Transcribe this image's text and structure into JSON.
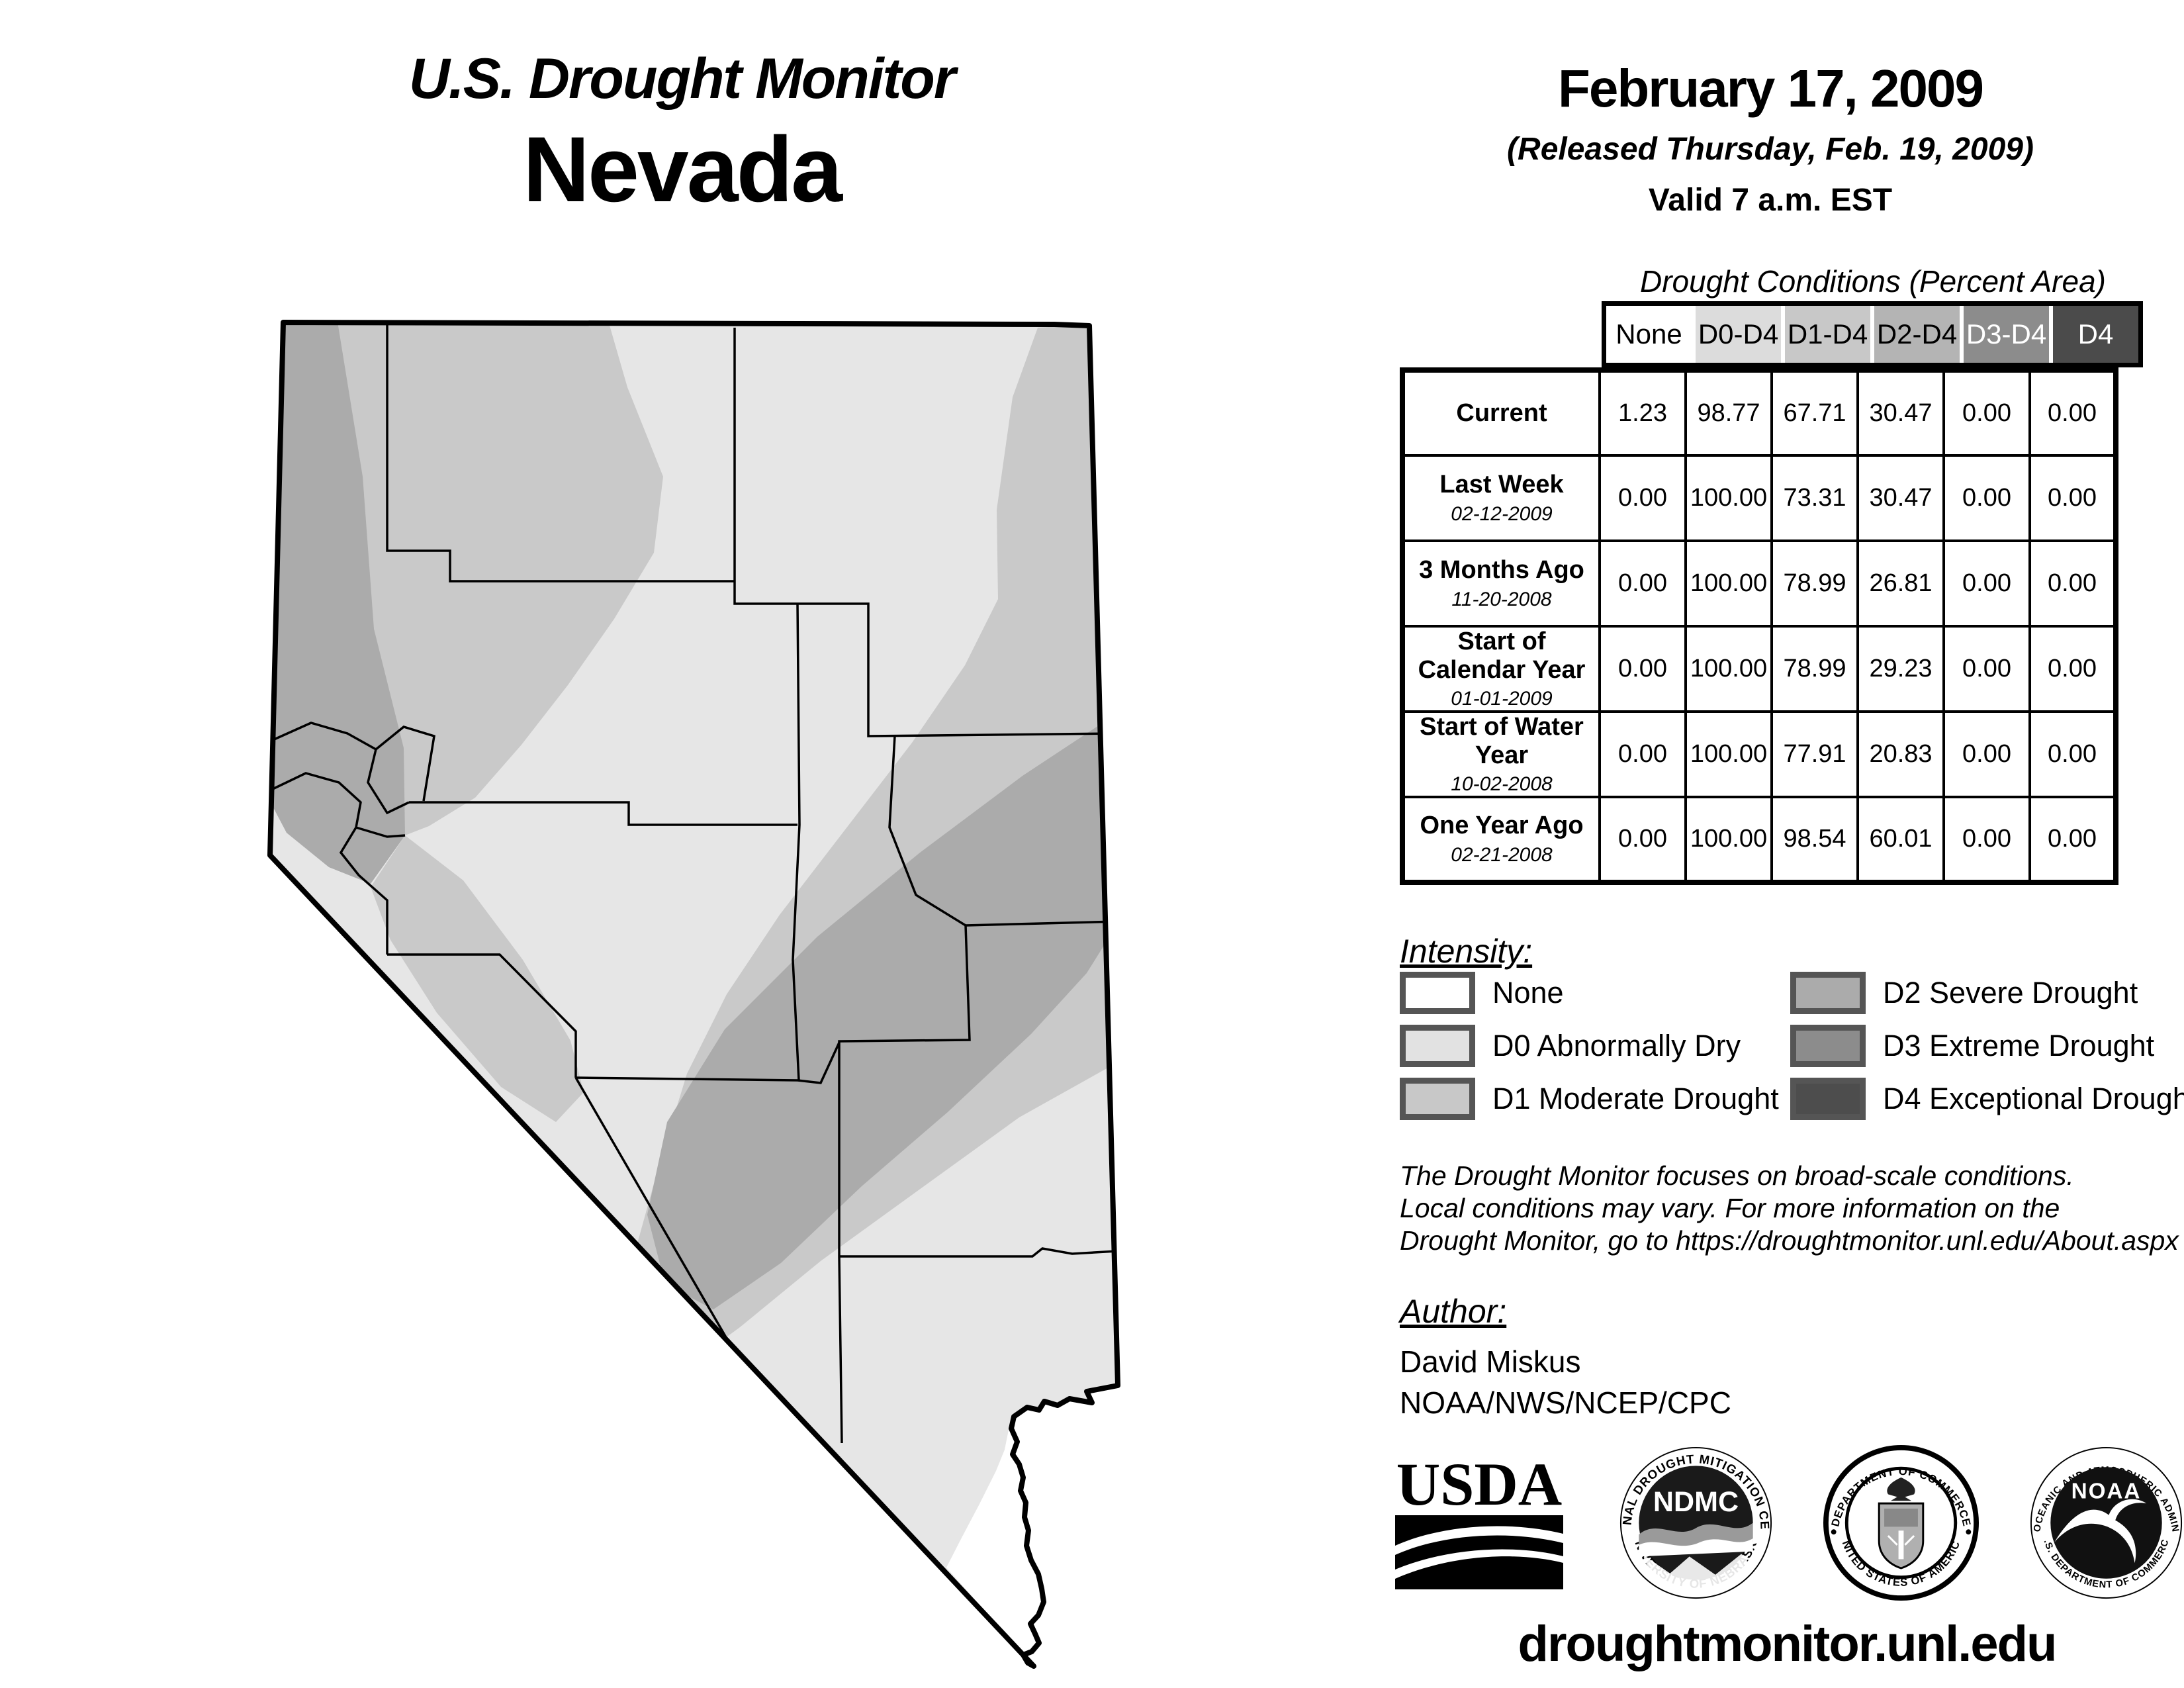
{
  "header": {
    "title": "U.S. Drought Monitor",
    "state": "Nevada",
    "date": "February 17, 2009",
    "released": "(Released Thursday, Feb. 19, 2009)",
    "valid": "Valid 7 a.m. EST"
  },
  "table": {
    "title": "Drought Conditions (Percent Area)",
    "columns": [
      "None",
      "D0-D4",
      "D1-D4",
      "D2-D4",
      "D3-D4",
      "D4"
    ],
    "header_colors": {
      "none": "#ffffff",
      "d0d4": "#dcdcdc",
      "d1d4": "#c8c8c8",
      "d2d4": "#b4b4b4",
      "d3d4": "#8c8c8c",
      "d4": "#4b4b4b"
    },
    "rows": [
      {
        "label": "Current",
        "date": "",
        "values": [
          "1.23",
          "98.77",
          "67.71",
          "30.47",
          "0.00",
          "0.00"
        ]
      },
      {
        "label": "Last Week",
        "date": "02-12-2009",
        "values": [
          "0.00",
          "100.00",
          "73.31",
          "30.47",
          "0.00",
          "0.00"
        ]
      },
      {
        "label": "3 Months Ago",
        "date": "11-20-2008",
        "values": [
          "0.00",
          "100.00",
          "78.99",
          "26.81",
          "0.00",
          "0.00"
        ]
      },
      {
        "label": "Start of Calendar Year",
        "date": "01-01-2009",
        "values": [
          "0.00",
          "100.00",
          "78.99",
          "29.23",
          "0.00",
          "0.00"
        ]
      },
      {
        "label": "Start of Water Year",
        "date": "10-02-2008",
        "values": [
          "0.00",
          "100.00",
          "77.91",
          "20.83",
          "0.00",
          "0.00"
        ]
      },
      {
        "label": "One Year Ago",
        "date": "02-21-2008",
        "values": [
          "0.00",
          "100.00",
          "98.54",
          "60.01",
          "0.00",
          "0.00"
        ]
      }
    ]
  },
  "legend": {
    "title": "Intensity:",
    "items": [
      {
        "label": "None",
        "color": "#ffffff"
      },
      {
        "label": "D0 Abnormally Dry",
        "color": "#e2e2e2"
      },
      {
        "label": "D1 Moderate Drought",
        "color": "#c8c8c8"
      },
      {
        "label": "D2 Severe Drought",
        "color": "#ababab"
      },
      {
        "label": "D3 Extreme Drought",
        "color": "#8c8c8c"
      },
      {
        "label": "D4 Exceptional Drought",
        "color": "#4d4d4d"
      }
    ]
  },
  "disclaimer": {
    "lines": [
      "The Drought Monitor focuses on broad-scale conditions.",
      "Local conditions may vary. For more information on the",
      "Drought Monitor, go to https://droughtmonitor.unl.edu/About.aspx"
    ]
  },
  "author": {
    "heading": "Author:",
    "name": "David Miskus",
    "org": "NOAA/NWS/NCEP/CPC"
  },
  "footer": {
    "url": "droughtmonitor.unl.edu"
  },
  "logos": {
    "usda": {
      "text": "USDA"
    },
    "ndmc": {
      "center": "NDMC",
      "ring_top": "NATIONAL DROUGHT MITIGATION CENTER",
      "ring_bottom": "UNIVERSITY OF NEBRASKA"
    },
    "doc": {
      "ring_top": "DEPARTMENT OF COMMERCE",
      "ring_bottom": "UNITED STATES OF AMERICA"
    },
    "noaa": {
      "center": "NOAA",
      "ring_top": "NATIONAL OCEANIC AND ATMOSPHERIC ADMINISTRATION",
      "ring_bottom": "U.S. DEPARTMENT OF COMMERCE"
    }
  },
  "map": {
    "colors": {
      "none": "#ffffff",
      "d0": "#e6e6e6",
      "d1": "#c9c9c9",
      "d2": "#ababab"
    },
    "state": "Nevada"
  }
}
